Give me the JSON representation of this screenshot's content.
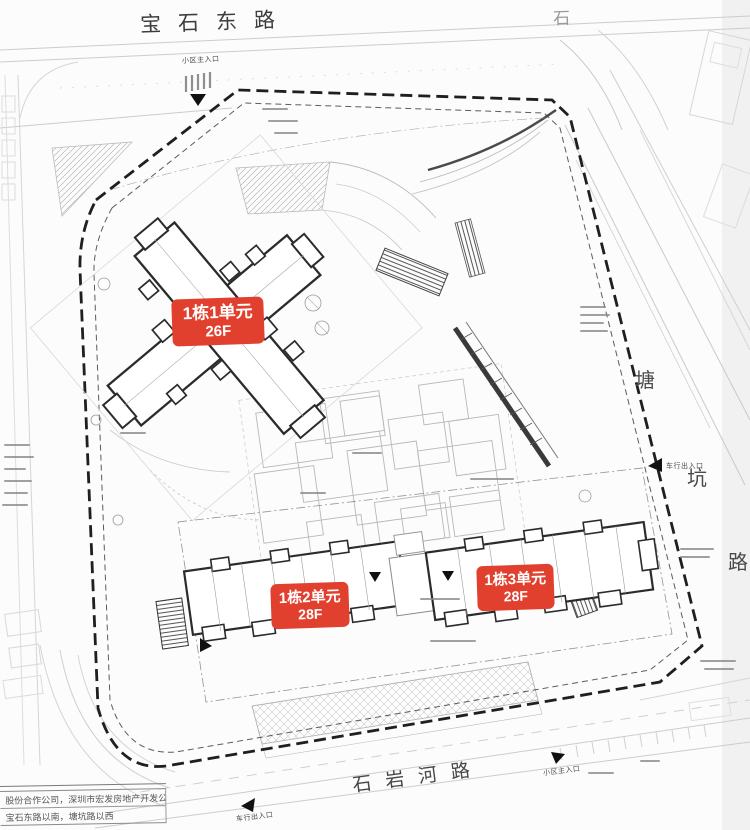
{
  "roads": {
    "top_label": "宝石东路",
    "top_right_partial_label": "石",
    "right_label_chars": [
      "塘",
      "坑",
      "路"
    ],
    "bottom_label": "石岩河路"
  },
  "building_labels": [
    {
      "name": "1栋1单元",
      "floors": "26F"
    },
    {
      "name": "1栋2单元",
      "floors": "28F"
    },
    {
      "name": "1栋3单元",
      "floors": "28F"
    }
  ],
  "entrance_labels": {
    "top": "小区主入口",
    "right": "车行出入口",
    "bottom_left": "车行出入口",
    "bottom_right": "小区主入口"
  },
  "title_block": {
    "row1": "股份合作公司，深圳市宏发房地产开发公司",
    "row2": "宝石东路以南，塘坑路以西"
  },
  "colors": {
    "annotation_red": "#e2402e",
    "drawing_dark": "#2b2b2b",
    "drawing_light": "#c9c9c9"
  }
}
